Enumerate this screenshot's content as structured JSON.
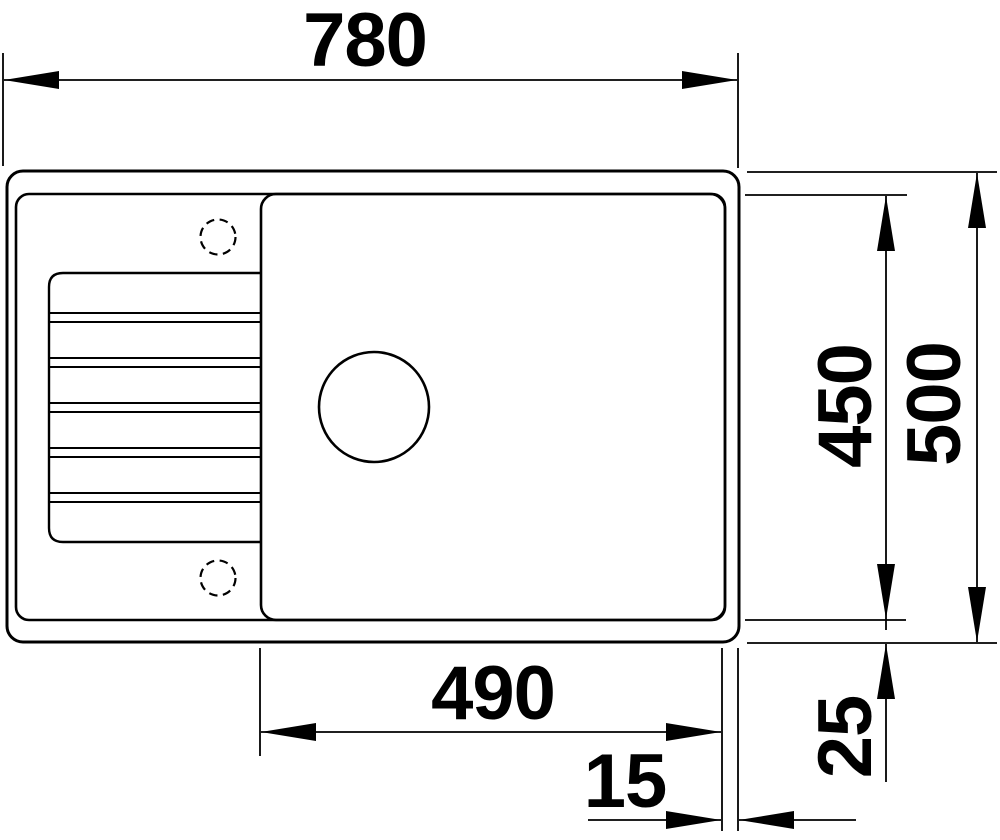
{
  "drawing": {
    "subject": "Kitchen sink with drainboard - top view technical drawing",
    "units": "mm",
    "colors": {
      "line": "#000000",
      "background": "#ffffff"
    },
    "dimensions": {
      "overall_width": "780",
      "overall_depth": "500",
      "inner_depth": "450",
      "bowl_width": "490",
      "right_rim": "15",
      "bottom_rim": "25"
    },
    "features": {
      "tap_holes": 2,
      "drainboard_ribs": 5,
      "drain_holes": 1
    }
  }
}
